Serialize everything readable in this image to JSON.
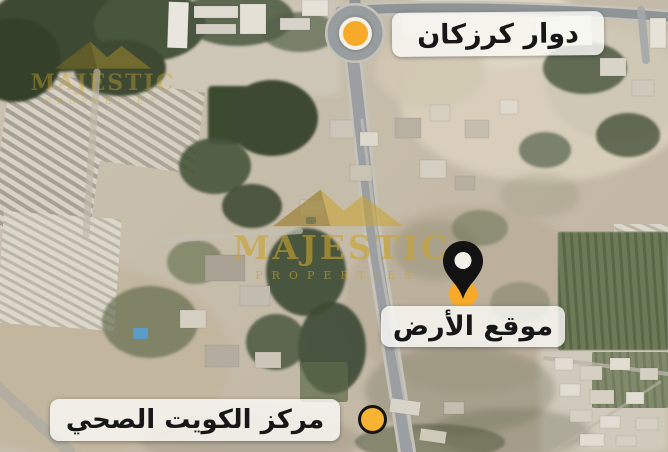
{
  "labels": {
    "roundabout": "دوار كرزكان",
    "land_site": "موقع الأرض",
    "health_center": "مركز الكويت الصحي"
  },
  "watermark": {
    "title": "MAJESTIC",
    "subtitle": "PROPERTIES"
  },
  "colors": {
    "marker_yellow": "#F7A92A",
    "marker_yellow_bright": "#F9B332",
    "pin_black": "#121212",
    "label_text": "#171717",
    "watermark_gold": "#C9A42E"
  }
}
